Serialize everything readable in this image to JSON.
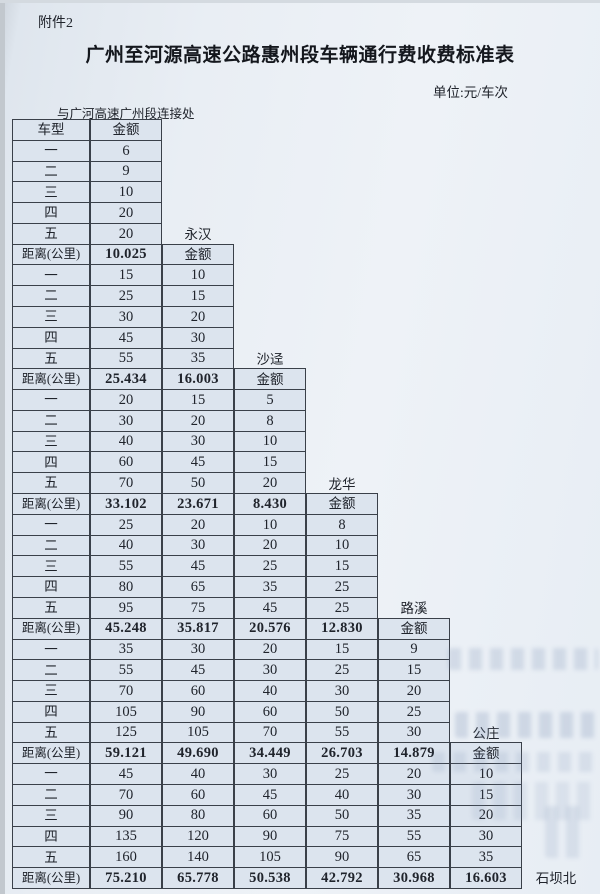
{
  "page": {
    "attachment_label": "附件2",
    "title": "广州至河源高速公路惠州段车辆通行费收费标准表",
    "unit_note": "单位:元/车次",
    "origin_label": "与广河高速广州段连接处"
  },
  "table": {
    "vehicle_type_header": "车型",
    "amount_header": "金额",
    "distance_label": "距离(公里)",
    "vehicle_classes": [
      "一",
      "二",
      "三",
      "四",
      "五"
    ],
    "stations": [
      "永汉",
      "沙迳",
      "龙华",
      "路溪",
      "公庄",
      "石坝北"
    ],
    "blocks": [
      {
        "next_station": "永汉",
        "fees": [
          [
            "6"
          ],
          [
            "9"
          ],
          [
            "10"
          ],
          [
            "20"
          ],
          [
            "20"
          ]
        ],
        "distances": [
          "10.025"
        ]
      },
      {
        "next_station": "沙迳",
        "fees": [
          [
            "15",
            "10"
          ],
          [
            "25",
            "15"
          ],
          [
            "30",
            "20"
          ],
          [
            "45",
            "30"
          ],
          [
            "55",
            "35"
          ]
        ],
        "distances": [
          "25.434",
          "16.003"
        ]
      },
      {
        "next_station": "龙华",
        "fees": [
          [
            "20",
            "15",
            "5"
          ],
          [
            "30",
            "20",
            "8"
          ],
          [
            "40",
            "30",
            "10"
          ],
          [
            "60",
            "45",
            "15"
          ],
          [
            "70",
            "50",
            "20"
          ]
        ],
        "distances": [
          "33.102",
          "23.671",
          "8.430"
        ]
      },
      {
        "next_station": "路溪",
        "fees": [
          [
            "25",
            "20",
            "10",
            "8"
          ],
          [
            "40",
            "30",
            "20",
            "10"
          ],
          [
            "55",
            "45",
            "25",
            "15"
          ],
          [
            "80",
            "65",
            "35",
            "25"
          ],
          [
            "95",
            "75",
            "45",
            "25"
          ]
        ],
        "distances": [
          "45.248",
          "35.817",
          "20.576",
          "12.830"
        ]
      },
      {
        "next_station": "公庄",
        "fees": [
          [
            "35",
            "30",
            "20",
            "15",
            "9"
          ],
          [
            "55",
            "45",
            "30",
            "25",
            "15"
          ],
          [
            "70",
            "60",
            "40",
            "30",
            "20"
          ],
          [
            "105",
            "90",
            "60",
            "50",
            "25"
          ],
          [
            "125",
            "105",
            "70",
            "55",
            "30"
          ]
        ],
        "distances": [
          "59.121",
          "49.690",
          "34.449",
          "26.703",
          "14.879"
        ]
      },
      {
        "next_station": "石坝北",
        "fees": [
          [
            "45",
            "40",
            "30",
            "25",
            "20",
            "10"
          ],
          [
            "70",
            "60",
            "45",
            "40",
            "30",
            "15"
          ],
          [
            "90",
            "80",
            "60",
            "50",
            "35",
            "20"
          ],
          [
            "135",
            "120",
            "90",
            "75",
            "55",
            "30"
          ],
          [
            "160",
            "140",
            "105",
            "90",
            "65",
            "35"
          ]
        ],
        "distances": [
          "75.210",
          "65.778",
          "50.538",
          "42.792",
          "30.968",
          "16.603"
        ]
      }
    ]
  }
}
